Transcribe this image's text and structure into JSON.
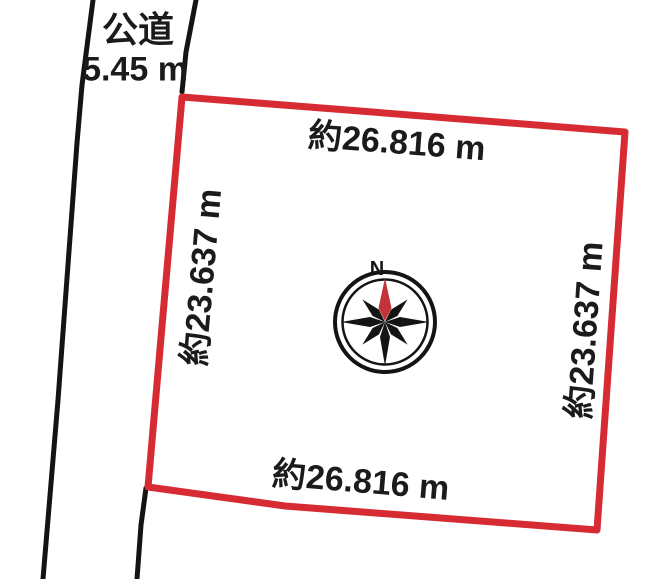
{
  "figure": {
    "background_color": "#ffffff",
    "road": {
      "name": "公道",
      "width_label": "5.45 m",
      "edge_color": "#141414"
    },
    "plot": {
      "border_color": "#d62b33",
      "dimensions": {
        "top": "約26.816 m",
        "bottom": "約26.816 m",
        "left": "約23.637 m",
        "right": "約23.637 m"
      }
    },
    "compass": {
      "north_label": "N",
      "ring_color": "#141414",
      "star_color": "#141414",
      "needle_color": "#c4323a"
    }
  }
}
